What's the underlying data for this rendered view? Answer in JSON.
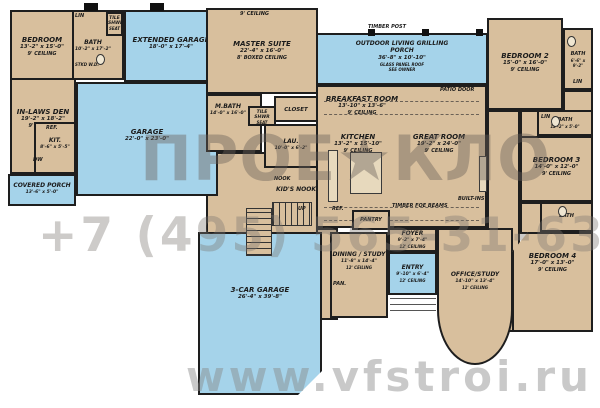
{
  "watermark": {
    "logo": "ПРОЕ★КЛО",
    "phone": "+7 (495) 565-31-63",
    "website": "www.vfstroi.ru"
  },
  "colors": {
    "room_fill": "#d8bf9d",
    "garage_fill": "#a5d3ea",
    "wall": "#1e1e1e"
  },
  "rooms": {
    "bedroom1": {
      "name": "BEDROOM",
      "dims": "13'-2\" x 15'-0\"",
      "ceiling": "9' CEILING"
    },
    "bath1": {
      "name": "BATH",
      "dims": "10'-2\" x 17'-2\""
    },
    "tile_shwr1": {
      "name": "TILE SHWR",
      "note": "SEAT"
    },
    "inlaws_den": {
      "name": "IN-LAWS DEN",
      "dims": "19'-2\" x 18'-2\"",
      "ceiling": "9' CEILING"
    },
    "kit": {
      "name": "KIT.",
      "dims": "8'-6\" x 5'-5\""
    },
    "covered_porch": {
      "name": "COVERED PORCH",
      "dims": "13'-6\" x 5'-0\""
    },
    "extended_garage": {
      "name": "EXTENDED GARAGE",
      "dims": "18'-0\" x 17'-4\""
    },
    "garage": {
      "name": "GARAGE",
      "dims": "22'-0\" x 23'-0\""
    },
    "three_car_garage": {
      "name": "3-CAR GARAGE",
      "dims": "26'-4\" x 39'-8\""
    },
    "master_suite": {
      "name": "MASTER SUITE",
      "dims": "22'-4\" x 16'-0\"",
      "ceiling": "8' BOXED CEILING"
    },
    "master_bath": {
      "name": "M.BATH",
      "dims": "14'-0\" x 16'-0\""
    },
    "tile_shwr2": {
      "name": "TILE SHWR",
      "note": "SEAT"
    },
    "closet": {
      "name": "CLOSET"
    },
    "laundry": {
      "name": "LAU.",
      "dims": "10'-0\" x 6'-2\""
    },
    "kids_nook": {
      "name": "KID'S NOOK"
    },
    "outdoor_living": {
      "name": "OUTDOOR LIVING GRILLING PORCH",
      "dims": "36'-8\" x 10'-10\"",
      "note": "GLASS PANEL ROOF",
      "note2": "SEE OWNER"
    },
    "breakfast": {
      "name": "BREAKFAST ROOM",
      "dims": "13'-10\" x 13'-6\"",
      "ceiling": "9' CEILING"
    },
    "kitchen": {
      "name": "KITCHEN",
      "dims": "13'-2\" x 15'-10\"",
      "ceiling": "9' CEILING"
    },
    "great_room": {
      "name": "GREAT ROOM",
      "dims": "19'-2\" x 24'-0\"",
      "ceiling": "9' CEILING"
    },
    "pantry": {
      "name": "PANTRY"
    },
    "foyer": {
      "name": "FOYER",
      "dims": "9'-2\" x 7'-4\"",
      "ceiling": "12' CEILING"
    },
    "dining_study": {
      "name": "DINING / STUDY",
      "dims": "11'-8\" x 14'-4\"",
      "ceiling": "12' CEILING"
    },
    "entry": {
      "name": "ENTRY",
      "dims": "9'-10\" x 6'-4\"",
      "ceiling": "12' CEILING"
    },
    "office_study": {
      "name": "OFFICE/STUDY",
      "dims": "14'-10\" x 13'-4\"",
      "ceiling": "12' CEILING"
    },
    "bedroom2": {
      "name": "BEDROOM 2",
      "dims": "15'-0\" x 16'-0\"",
      "ceiling": "9' CEILING"
    },
    "bath2": {
      "name": "BATH",
      "dims": "6'-6\" x 9'-2\""
    },
    "bath3": {
      "name": "BATH",
      "dims": "12'-2\" x 5'-0\""
    },
    "bedroom3": {
      "name": "BEDROOM 3",
      "dims": "14'-0\" x 12'-0\"",
      "ceiling": "9' CEILING"
    },
    "bath4": {
      "name": "BATH"
    },
    "bedroom4": {
      "name": "BEDROOM 4",
      "dims": "17'-0\" x 13'-0\"",
      "ceiling": "9' CEILING"
    }
  },
  "notes": {
    "ceiling9": "9' CEILING",
    "timber_post": "TIMBER POST",
    "patio_door": "PATIO DOOR",
    "timber_beams": "TIMBER FOE BEAMS",
    "built_ins": "BUILT-INS",
    "lin": "LIN",
    "ref": "REF.",
    "dw": "DW",
    "pan": "PAN.",
    "up": "UP",
    "stkd_wd": "STKD W.D.",
    "nook": "NOOK"
  }
}
